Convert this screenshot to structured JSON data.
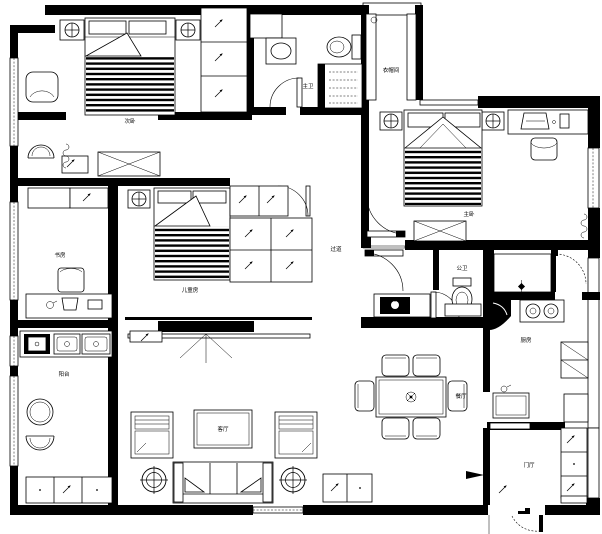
{
  "rooms": {
    "bedroom2": "次卧",
    "master_bath": "主卫",
    "cloakroom": "衣帽间",
    "master_bedroom": "主卧",
    "study": "书房",
    "kids_room": "儿童房",
    "hallway": "过道",
    "balcony": "阳台",
    "living": "客厅",
    "dining": "餐厅",
    "bath2": "公卫",
    "kitchen": "厨房",
    "foyer": "门厅"
  },
  "symbols": {
    "direction-arrow": "↗",
    "ceiling-lamp": "⊕",
    "floor-drain": "⊠"
  },
  "colors": {
    "line": "#000000",
    "paper": "#ffffff"
  }
}
